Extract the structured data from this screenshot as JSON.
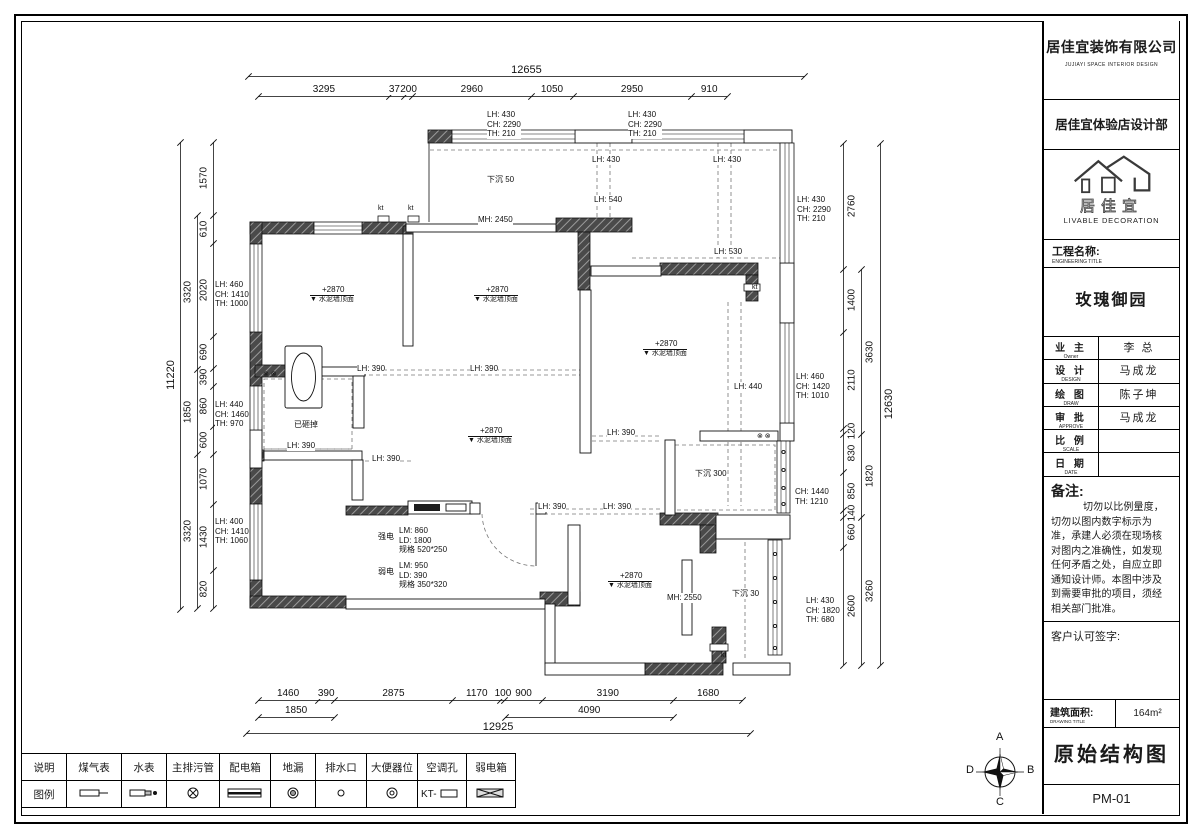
{
  "title_block": {
    "company": "居佳宜装饰有限公司",
    "company_en": "JUJIAYI  SPACE  INTERIOR  DESIGN",
    "department": "居佳宜体验店设计部",
    "logo_text": "居佳宜",
    "logo_sub": "LIVABLE DECORATION",
    "project_label": "工程名称:",
    "project_label_en": "ENGINEERING TITLE",
    "project_name": "玫瑰御园",
    "rows": [
      {
        "label": "业 主",
        "label_en": "Owner",
        "value": "李 总"
      },
      {
        "label": "设 计",
        "label_en": "DESIGN",
        "value": "马成龙"
      },
      {
        "label": "绘 图",
        "label_en": "DRAW",
        "value": "陈子坤"
      },
      {
        "label": "审 批",
        "label_en": "APPROVE",
        "value": "马成龙"
      },
      {
        "label": "比 例",
        "label_en": "SCALE",
        "value": ""
      },
      {
        "label": "日 期",
        "label_en": "DATE",
        "value": ""
      }
    ],
    "notes_label": "备注:",
    "notes": "切勿以比例量度，切勿以图内数字标示为准，承建人必须在现场核对图内之准确性，如发现任何矛盾之处，自应立即通知设计师。本图中涉及到需要审批的项目，须经相关部门批准。",
    "signature_label": "客户认可签字:",
    "area_label": "建筑面积:",
    "area_label_en": "DRAWING TITLE",
    "area_value": "164m²",
    "drawing_title": "原始结构图",
    "drawing_no": "PM-01"
  },
  "legend": {
    "header": "说明",
    "symbol_row_header": "图例",
    "items": [
      {
        "label": "煤气表",
        "icon": "gas-meter-icon"
      },
      {
        "label": "水表",
        "icon": "water-meter-icon"
      },
      {
        "label": "主排污管",
        "icon": "main-drain-icon"
      },
      {
        "label": "配电箱",
        "icon": "power-box-icon"
      },
      {
        "label": "地漏",
        "icon": "floor-drain-icon"
      },
      {
        "label": "排水口",
        "icon": "drain-outlet-icon"
      },
      {
        "label": "大便器位",
        "icon": "toilet-icon"
      },
      {
        "label": "空调孔",
        "icon": "ac-hole-icon"
      },
      {
        "label": "弱电箱",
        "icon": "weak-current-box-icon"
      }
    ]
  },
  "compass": {
    "top": "A",
    "right": "B",
    "bottom": "C",
    "left": "D"
  },
  "plan": {
    "chains": [
      {
        "id": "top-detail",
        "dir": "h",
        "x": 258,
        "y": 96,
        "scale": 0.04,
        "labels": [
          "3295",
          "370",
          "200",
          "2960",
          "1050",
          "2950",
          "910"
        ]
      },
      {
        "id": "top-overall",
        "dir": "h",
        "x": 248,
        "y": 76,
        "scale": 0.044,
        "cls": "ov",
        "labels": [
          "12655"
        ]
      },
      {
        "id": "bottom-detail",
        "dir": "h",
        "x": 258,
        "y": 700,
        "scale": 0.0412,
        "labels": [
          "1460",
          "390",
          "2875",
          "1170",
          "100",
          "900",
          "3190",
          "1680"
        ]
      },
      {
        "id": "bottom-mid-left",
        "dir": "h",
        "x": 258,
        "y": 717,
        "scale": 0.0412,
        "labels": [
          "1850"
        ]
      },
      {
        "id": "bottom-mid-right",
        "dir": "h",
        "x": 505,
        "y": 717,
        "scale": 0.0412,
        "labels": [
          "4090"
        ]
      },
      {
        "id": "bottom-overall",
        "dir": "h",
        "x": 246,
        "y": 733,
        "scale": 0.039,
        "cls": "ov",
        "labels": [
          "12925"
        ]
      },
      {
        "id": "left-detail",
        "dir": "v",
        "x": 213,
        "y": 142,
        "scale": 0.0463,
        "side": -1,
        "labels": [
          "1570",
          "610",
          "2020",
          "690",
          "390",
          "860",
          "600",
          "1070",
          "1430",
          "820"
        ]
      },
      {
        "id": "left-groups",
        "dir": "v",
        "x": 197,
        "y": 215,
        "scale": 0.0463,
        "side": -1,
        "labels": [
          "3320",
          "1850",
          "3320"
        ]
      },
      {
        "id": "left-overall",
        "dir": "v",
        "x": 180,
        "y": 142,
        "scale": 0.0416,
        "side": -1,
        "cls": "ov",
        "labels": [
          "11220"
        ]
      },
      {
        "id": "right-detail",
        "dir": "v",
        "x": 843,
        "y": 143,
        "scale": 0.0455,
        "side": 1,
        "labels": [
          "2760",
          "1400",
          "2110",
          "120",
          "830",
          "850",
          "140",
          "660",
          "2600"
        ]
      },
      {
        "id": "right-groups",
        "dir": "v",
        "x": 861,
        "y": 269,
        "scale": 0.0455,
        "side": 1,
        "labels": [
          "3630",
          "1820",
          "3260"
        ]
      },
      {
        "id": "right-overall",
        "dir": "v",
        "x": 880,
        "y": 143,
        "scale": 0.0413,
        "side": 1,
        "cls": "ov",
        "labels": [
          "12630"
        ]
      }
    ],
    "annotations": [
      {
        "t": "LH: 430\nCH: 2290\nTH: 210",
        "x": 487,
        "y": 110,
        "c": "sm"
      },
      {
        "t": "LH: 430\nCH: 2290\nTH: 210",
        "x": 628,
        "y": 110,
        "c": "sm"
      },
      {
        "t": "LH: 430\nCH: 2290\nTH: 210",
        "x": 797,
        "y": 195,
        "c": "sm"
      },
      {
        "t": "LH: 460\nCH: 1410\nTH: 1000",
        "x": 215,
        "y": 280,
        "c": "sm"
      },
      {
        "t": "LH: 440\nCH: 1460\nTH: 970",
        "x": 215,
        "y": 400,
        "c": "sm"
      },
      {
        "t": "LH: 400\nCH: 1410\nTH: 1060",
        "x": 215,
        "y": 517,
        "c": "sm"
      },
      {
        "t": "LH: 460\nCH: 1420\nTH: 1010",
        "x": 796,
        "y": 372,
        "c": "sm"
      },
      {
        "t": "CH: 1440\nTH: 1210",
        "x": 795,
        "y": 487,
        "c": "sm"
      },
      {
        "t": "LH: 430\nCH: 1820\nTH: 680",
        "x": 806,
        "y": 596,
        "c": "sm"
      },
      {
        "t": "LH: 430",
        "x": 592,
        "y": 155,
        "c": "sm"
      },
      {
        "t": "LH: 430",
        "x": 713,
        "y": 155,
        "c": "sm"
      },
      {
        "t": "LH: 540",
        "x": 594,
        "y": 195,
        "c": "sm"
      },
      {
        "t": "LH: 530",
        "x": 714,
        "y": 247,
        "c": "sm"
      },
      {
        "t": "LH: 390",
        "x": 357,
        "y": 364,
        "c": "sm"
      },
      {
        "t": "LH: 390",
        "x": 470,
        "y": 364,
        "c": "sm"
      },
      {
        "t": "LH: 390",
        "x": 607,
        "y": 428,
        "c": "sm"
      },
      {
        "t": "LH: 390",
        "x": 287,
        "y": 441,
        "c": "sm"
      },
      {
        "t": "LH: 390",
        "x": 372,
        "y": 454,
        "c": "sm"
      },
      {
        "t": "LH: 390",
        "x": 538,
        "y": 502,
        "c": "sm"
      },
      {
        "t": "LH: 390",
        "x": 603,
        "y": 502,
        "c": "sm"
      },
      {
        "t": "LH: 440",
        "x": 734,
        "y": 382,
        "c": "sm"
      },
      {
        "t": "MH: 2450",
        "x": 478,
        "y": 215,
        "c": "sm"
      },
      {
        "t": "MH: 2550",
        "x": 667,
        "y": 593,
        "c": "sm"
      },
      {
        "t": "下沉 50",
        "x": 487,
        "y": 175,
        "c": "sm"
      },
      {
        "t": "下沉 300",
        "x": 695,
        "y": 469,
        "c": "sm"
      },
      {
        "t": "下沉 30",
        "x": 732,
        "y": 589,
        "c": "sm"
      },
      {
        "t": "+2870",
        "t2": "水泥墙顶面",
        "x": 310,
        "y": 285,
        "c": "elev"
      },
      {
        "t": "+2870",
        "t2": "水泥墙顶面",
        "x": 474,
        "y": 285,
        "c": "elev"
      },
      {
        "t": "+2870",
        "t2": "水泥墙顶面",
        "x": 643,
        "y": 339,
        "c": "elev"
      },
      {
        "t": "+2870",
        "t2": "水泥墙顶面",
        "x": 468,
        "y": 426,
        "c": "elev"
      },
      {
        "t": "+2870",
        "t2": "水泥墙顶面",
        "x": 608,
        "y": 571,
        "c": "elev"
      },
      {
        "t": "强电",
        "x": 378,
        "y": 532,
        "c": "sm"
      },
      {
        "t": "LM: 860\nLD: 1800\n规格 520*250",
        "x": 399,
        "y": 526,
        "c": "sm"
      },
      {
        "t": "弱电",
        "x": 378,
        "y": 567,
        "c": "sm"
      },
      {
        "t": "LM: 950\nLD: 390\n规格 350*320",
        "x": 399,
        "y": 561,
        "c": "sm"
      },
      {
        "t": "已砸掉",
        "x": 294,
        "y": 420,
        "c": "sm"
      },
      {
        "t": "kt",
        "x": 752,
        "y": 284,
        "c": "xs"
      },
      {
        "t": "kt",
        "x": 721,
        "y": 652,
        "c": "xs"
      },
      {
        "t": "kt",
        "x": 378,
        "y": 205,
        "c": "xs"
      },
      {
        "t": "kt",
        "x": 408,
        "y": 205,
        "c": "xs"
      },
      {
        "t": "⊗ ⊗",
        "x": 263,
        "y": 371,
        "c": "xs"
      },
      {
        "t": "⊗ ⊗",
        "x": 757,
        "y": 433,
        "c": "xs"
      }
    ]
  }
}
